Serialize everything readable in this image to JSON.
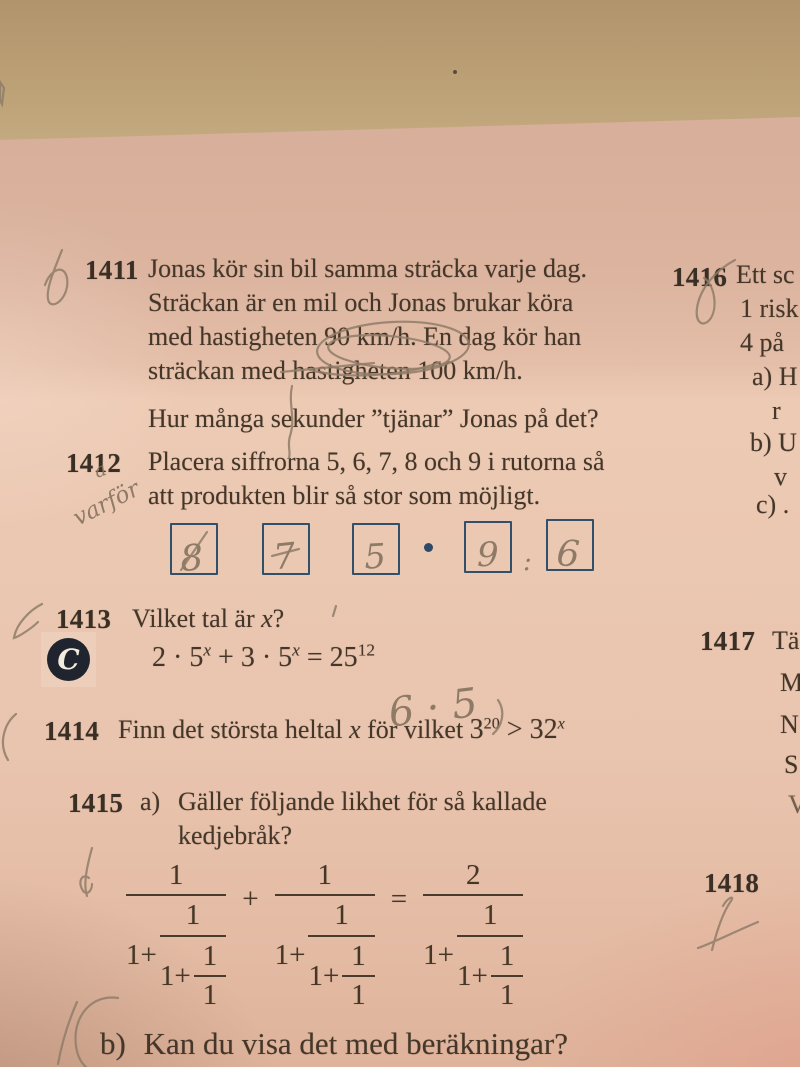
{
  "colors": {
    "box_blue": "#33506b",
    "badge_navy": "#20242f",
    "pencil_gray": "#8f7d69"
  },
  "problems": {
    "p1411": {
      "number": "1411",
      "lines": [
        "Jonas kör sin bil samma sträcka varje dag.",
        "Sträckan är en mil och Jonas brukar köra",
        "med hastigheten 90 km/h. En dag kör han",
        "sträckan med hastigheten 100 km/h."
      ],
      "question": "Hur många sekunder ”tjänar” Jonas på det?"
    },
    "p1412": {
      "number": "1412",
      "lines": [
        "Placera siffrorna 5, 6, 7, 8 och 9 i rutorna så",
        "att produkten blir så stor som möjligt."
      ],
      "dot": "·",
      "pencil_digits": [
        "8",
        "7",
        "5",
        "9",
        "6"
      ],
      "pencil_colon": ":",
      "pencil_letter": "a",
      "pencil_word": "varför"
    },
    "p1413": {
      "number": "1413",
      "title_pre": "Vilket tal är ",
      "title_x": "x",
      "title_post": "?",
      "badge": "C",
      "eq": {
        "p1": "2 · 5",
        "s1": "x",
        "p2": " + 3 · 5",
        "s2": "x",
        "p3": " = 25",
        "s3": "12"
      },
      "pencil_work": "6 · 5"
    },
    "p1414": {
      "number": "1414",
      "pre": "Finn det största heltal ",
      "x": "x",
      "post": " för vilket  ",
      "b1": "3",
      "e1": "20",
      "rel": " > ",
      "b2": "32",
      "e2": "x"
    },
    "p1415": {
      "number": "1415",
      "a_label": "a)",
      "a_lines": [
        "Gäller följande likhet för så kallade",
        "kedjebråk?"
      ],
      "b_label": "b)",
      "b_text": "Kan du visa det med beräkningar?",
      "cf": {
        "n1": "1",
        "n2": "1",
        "n3": "2",
        "one": "1",
        "oneplus": "1+",
        "plus": "+",
        "eq": "="
      }
    },
    "p1416": {
      "number": "1416",
      "l1": "Ett sc",
      "l2": "1 risk",
      "l3": "4 på",
      "a": "a) H",
      "a2": "r",
      "b": "b) U",
      "b2": "v",
      "c": "c) ."
    },
    "p1417": {
      "number": "1417",
      "l1": "Tä",
      "l2": "M",
      "l3": "N",
      "l4": "S",
      "l5": "V"
    },
    "p1418": {
      "number": "1418"
    }
  }
}
